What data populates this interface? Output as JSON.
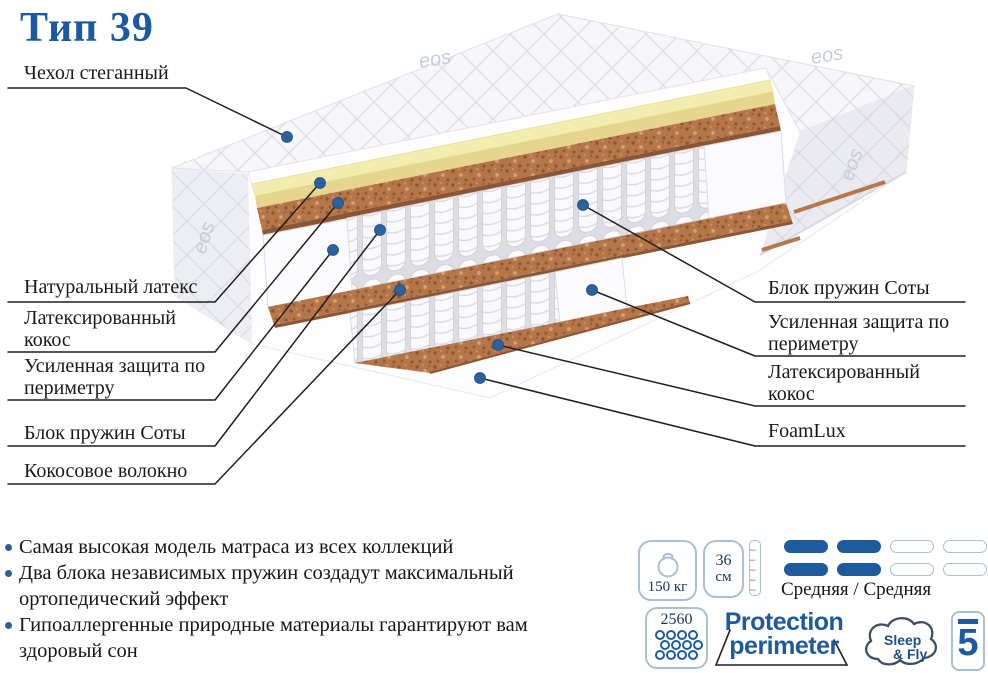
{
  "title": "Тип 39",
  "brand_watermark": "eos",
  "diagram": {
    "labels_left": [
      {
        "text": "Чехол стеганный"
      },
      {
        "text": "Натуральный латекс"
      },
      {
        "text": "Латексированный кокос"
      },
      {
        "text": "Усиленная защита по периметру"
      },
      {
        "text": "Блок пружин Соты"
      },
      {
        "text": "Кокосовое волокно"
      }
    ],
    "labels_right": [
      {
        "text": "Блок пружин Соты"
      },
      {
        "text": "Усиленная защита по периметру"
      },
      {
        "text": "Латексированный кокос"
      },
      {
        "text": "FoamLux"
      }
    ]
  },
  "features": [
    "Самая высокая модель матраса из всех коллекций",
    "Два блока независимых пружин создадут максимальный ортопедический эффект",
    "Гипоаллергенные природные материалы гарантируют вам здоровый сон"
  ],
  "specs": {
    "max_weight": "150 кг",
    "height_value": "36",
    "height_unit": "см",
    "firmness_label": "Средняя / Средняя",
    "springs_count": "2560",
    "protection_line1": "Protection",
    "protection_line2": "perimeter",
    "brand_line1": "Sleep",
    "brand_line2": "& Fly",
    "warranty_years": "5"
  },
  "colors": {
    "title_blue": "#1c59a4",
    "accent_blue": "#1e5b9e",
    "dot_blue": "#2a619f",
    "latex_yellow": "#f2ecae",
    "coir_brown": "#b5764a",
    "icon_border": "#a9bfd4",
    "line_black": "#1f1f1f"
  }
}
